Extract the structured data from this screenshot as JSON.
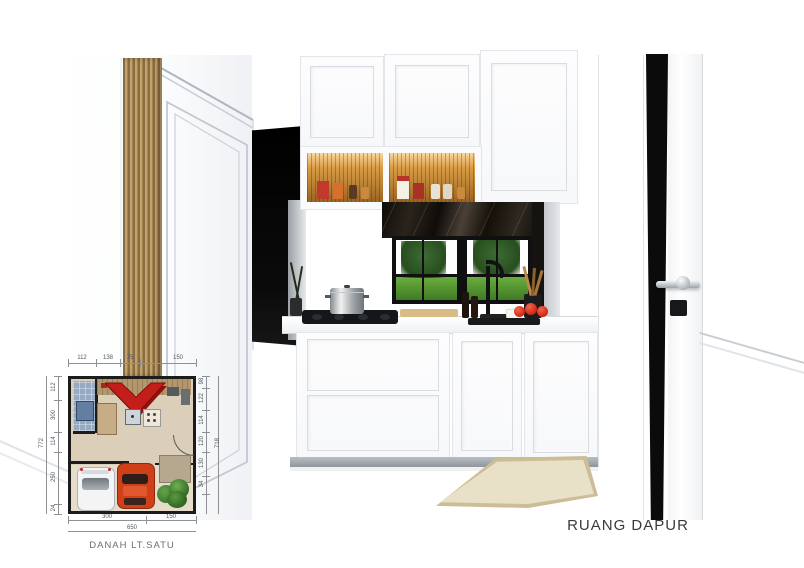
{
  "scene": {
    "room_label": "RUANG DAPUR"
  },
  "floor_plan": {
    "caption": "DANAH LT.SATU",
    "dims": {
      "top": [
        "112",
        "138",
        "75",
        "150"
      ],
      "left": [
        "112",
        "300",
        "114",
        "250",
        "24"
      ],
      "left_total": "772",
      "right": [
        "98",
        "122",
        "114",
        "120",
        "130",
        "34"
      ],
      "right_total": "718",
      "bottom": [
        "300",
        "150"
      ],
      "bottom_total": "650"
    }
  },
  "colors": {
    "arrow_red": "#c41e1a",
    "marble_dark": "#1b1610",
    "wood_slat": "#a8885a",
    "grass_green": "#4e8f35",
    "car_red": "#cf3f18",
    "plan_floor": "#dccfba",
    "bathroom_blue": "#96aac4"
  }
}
